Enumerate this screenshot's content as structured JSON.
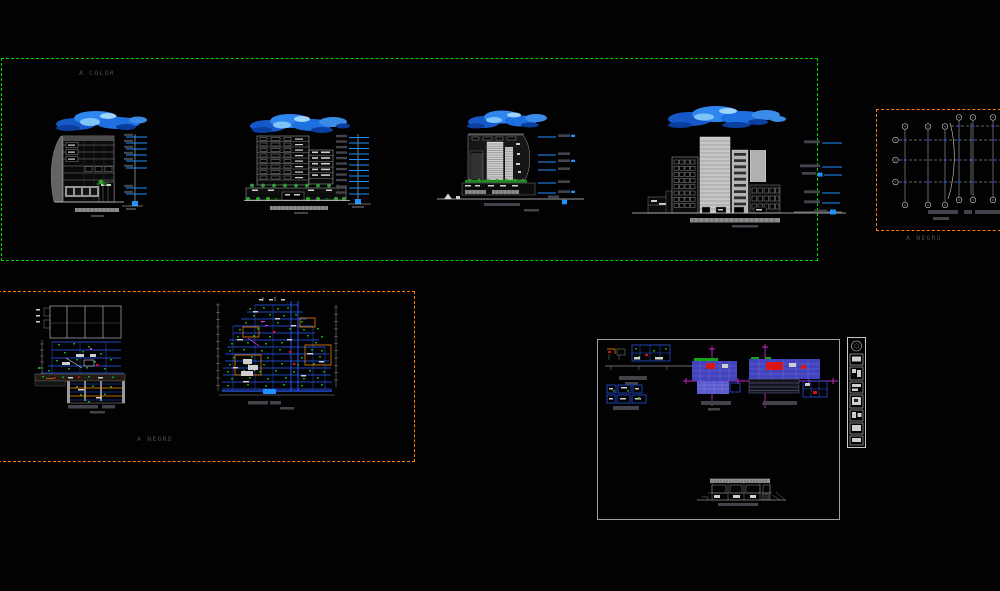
{
  "canvas": {
    "width": 1000,
    "height": 591,
    "background": "#020202"
  },
  "palette": {
    "green_box_border": "#00d400",
    "orange_box_border": "#ff7d00",
    "details_box_border": "#9aa0a6",
    "strip_border": "#c8c8c8",
    "label_text": "#4b4b55",
    "line_white": "#cfcfcf",
    "line_gray": "#8f8f8f",
    "cad_blue": "#2a5cff",
    "level_blue": "#1e90ff",
    "cloud_deep": "#1658c8",
    "cloud_mid": "#2f86ee",
    "cloud_light": "#7fc4f9",
    "cloud_dark": "#0a3fa0",
    "green_annotation": "#17a317",
    "vegetation": "#2f9f2f",
    "magenta": "#ff2bff",
    "red_mark": "#d91515",
    "orange_line": "#ff8c00",
    "hatch_blue": "#4343bd",
    "dim_text": "#43434c"
  },
  "viewports": {
    "color_set": {
      "label": "A COLOR"
    },
    "grid_plan": {
      "label": "A NEGRO"
    },
    "sections_set": {
      "label": "A NEGRO"
    }
  }
}
